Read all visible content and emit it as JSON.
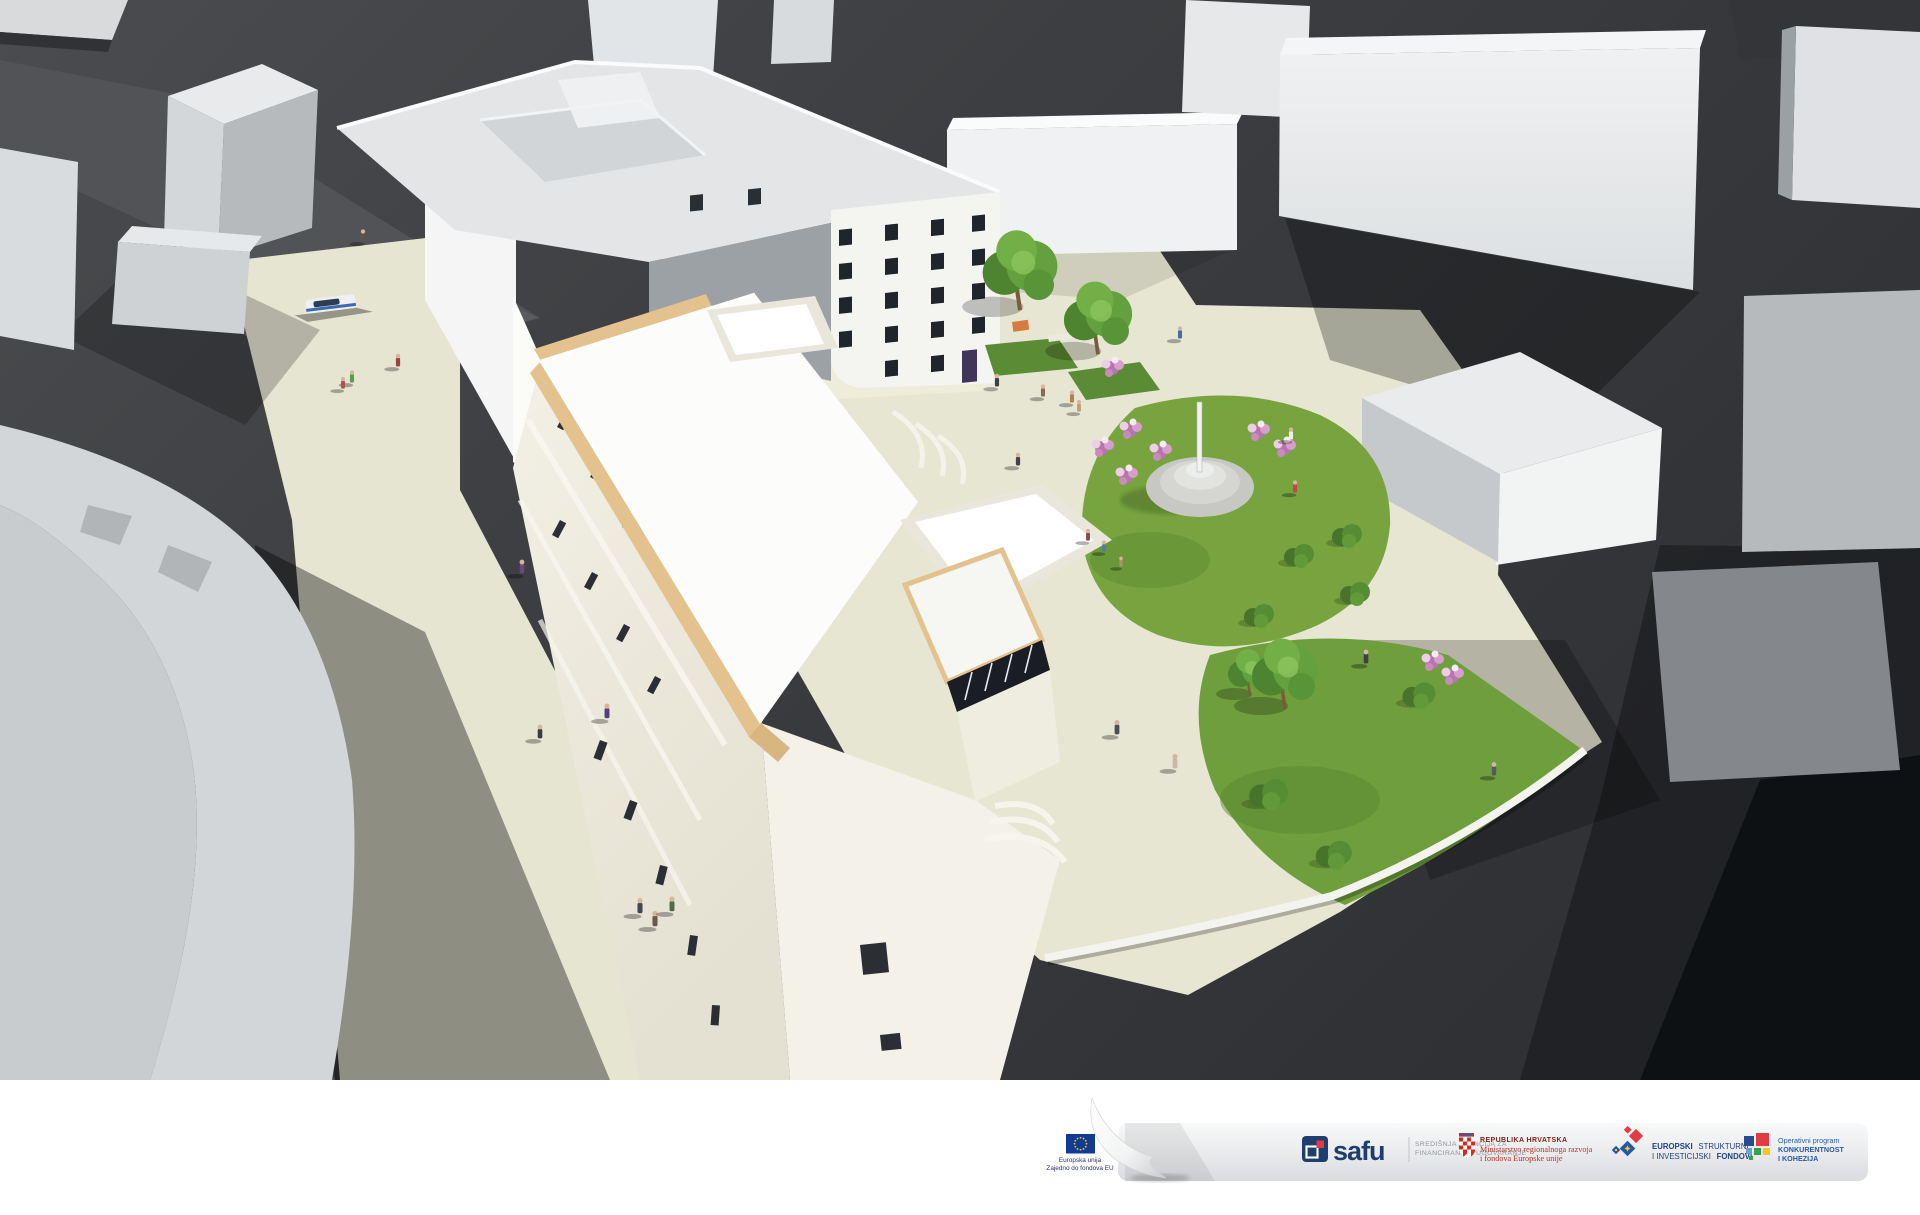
{
  "scene": {
    "kind": "aerial 3d architectural visualization",
    "colors": {
      "ground": "#3e4043",
      "ground_shadow": "#26282c",
      "massing_light": "#eceeef",
      "massing_side": "#b7babd",
      "pavement": "#e7e6d3",
      "existing_facade": "#f4f4f1",
      "window_dark": "#20252c",
      "new_roof": "#fcfcfa",
      "cornice_tan": "#e3c28e",
      "facade_cream": "#f0ede1",
      "grass": "#77a43f",
      "tree_green": "#63a03e",
      "flower_pink": "#c583b8",
      "monument_stone": "#cccdc9"
    }
  },
  "banner": {
    "eu": {
      "line1": "Europska unija",
      "line2": "Zajedno do fondova EU",
      "flag_blue": "#123a93",
      "star_yellow": "#ffcc00"
    },
    "safu": {
      "wordmark": "safu",
      "agency_line1": "SREDIŠNJA AGENCIJA ZA",
      "agency_line2": "FINANCIRANJE I UGOVARANJE",
      "navy": "#1e3e6f",
      "red": "#e63946"
    },
    "croatia": {
      "line1": "REPUBLIKA HRVATSKA",
      "line2": "Ministarstvo regionalnoga razvoja",
      "line3": "i fondova Europske unije",
      "dark_red": "#7d241c",
      "red": "#b5352c"
    },
    "esif": {
      "line1_bold": "EUROPSKI",
      "line1_rest": "STRUKTURNI",
      "line2_rest": "I INVESTICIJSKI",
      "line2_bold": "FONDOVI",
      "blue": "#24427e"
    },
    "opkk": {
      "line1": "Operativni program",
      "line2": "KONKURENTNOST",
      "line3": "I KOHEZIJA",
      "blue": "#2a5aa8"
    }
  }
}
